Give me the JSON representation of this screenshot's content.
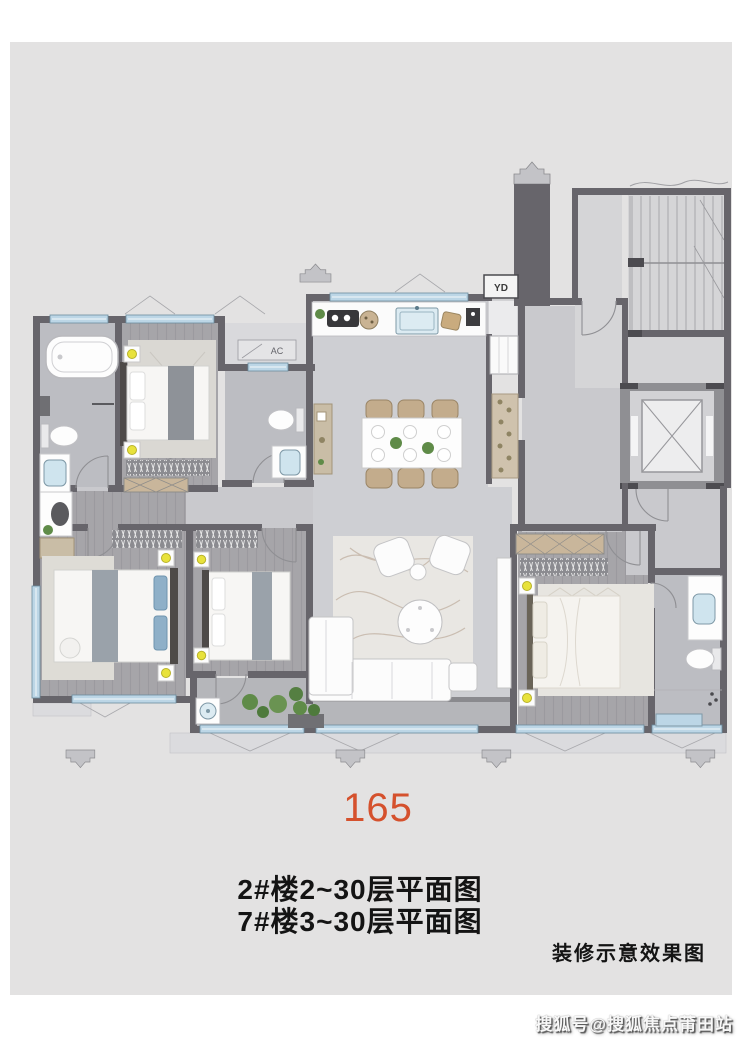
{
  "plan": {
    "labels": {
      "utility_shaft": "YD",
      "air_conditioner": "AC"
    }
  },
  "annotations": {
    "area_number": "165",
    "caption_line1": "2#楼2~30层平面图",
    "caption_line2": "7#楼3~30层平面图",
    "disclaimer": "装修示意效果图",
    "watermark": "搜狐号@搜狐焦点莆田站"
  },
  "colors": {
    "page_background": "#ffffff",
    "panel_background": "#e3e2e2",
    "area_number": "#d5512d",
    "caption_text": "#141414",
    "watermark_text": "#f8f8f8",
    "wall": "#67656b",
    "window": "#bcd6e6",
    "wood_floor": "#a6a5a9",
    "tile_floor": "#cecfd3"
  }
}
